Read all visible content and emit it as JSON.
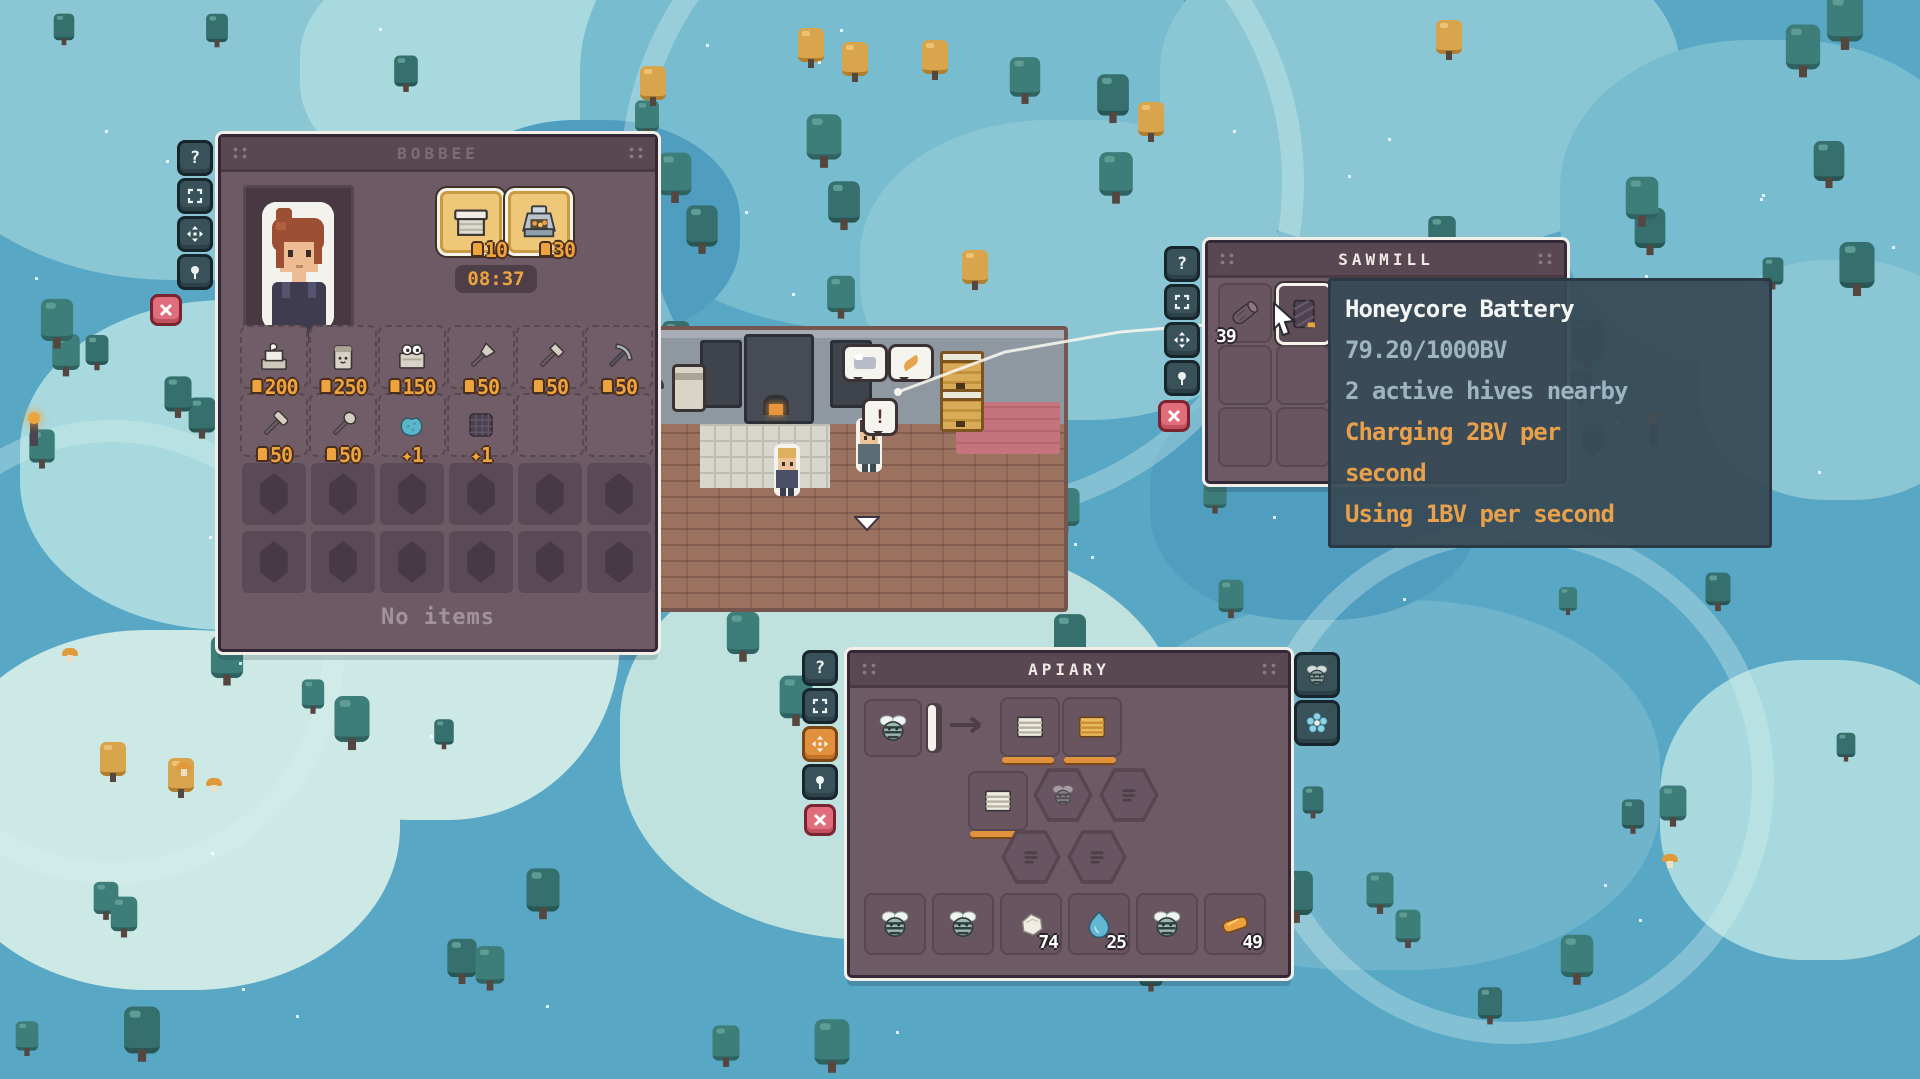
{
  "hud": {
    "help_label": "?"
  },
  "colors": {
    "accent_orange": "#e8a04b",
    "count_orange": "#eda43f",
    "panel_bg": "#6e5a64",
    "tooltip_bg": "#384a56",
    "water": "#57a7c5",
    "gold_slot": "#eec878",
    "close_button": "#e06c7c"
  },
  "player_panel": {
    "title": "BOBBEE",
    "timer": "08:37",
    "equipment": [
      {
        "icon": "workbench-icon",
        "count": "10"
      },
      {
        "icon": "smoker-icon",
        "count": "30"
      }
    ],
    "inventory": [
      {
        "icon": "jar-icon",
        "count": "200"
      },
      {
        "icon": "canister-icon",
        "count": "250"
      },
      {
        "icon": "bee-box-icon",
        "count": "150"
      },
      {
        "icon": "trowel-icon",
        "count": "50"
      },
      {
        "icon": "axe-icon",
        "count": "50"
      },
      {
        "icon": "pickaxe-icon",
        "count": "50"
      },
      {
        "icon": "hammer-icon",
        "count": "50"
      },
      {
        "icon": "scoop-icon",
        "count": "50"
      },
      {
        "icon": "sponge-icon",
        "count": "1"
      },
      {
        "icon": "net-icon",
        "count": "1"
      }
    ],
    "no_items_label": "No items"
  },
  "sawmill_panel": {
    "title": "SAWMILL",
    "input_slot": {
      "icon": "log-icon",
      "count": "39"
    },
    "hovered_slot": {
      "icon": "honeycore-battery-icon"
    }
  },
  "tooltip": {
    "lines": [
      {
        "text": "Honeycore Battery",
        "style": "title"
      },
      {
        "text": "79.20/1000BV",
        "style": "info"
      },
      {
        "text": "2 active hives nearby",
        "style": "info"
      },
      {
        "text": "Charging 2BV per",
        "style": "accent"
      },
      {
        "text": "second",
        "style": "accent"
      },
      {
        "text": "Using 1BV per second",
        "style": "accent"
      }
    ]
  },
  "apiary_panel": {
    "title": "APIARY",
    "input_bee_slot": {
      "icon": "bee-icon"
    },
    "frame_slots": [
      {
        "icon": "frame-empty-icon"
      },
      {
        "icon": "frame-full-icon"
      },
      {
        "icon": "frame-empty-icon"
      }
    ],
    "products": [
      {
        "icon": "bee-icon",
        "count": ""
      },
      {
        "icon": "bee-icon",
        "count": ""
      },
      {
        "icon": "wax-icon",
        "count": "74"
      },
      {
        "icon": "droplet-icon",
        "count": "25"
      },
      {
        "icon": "bee-icon",
        "count": ""
      },
      {
        "icon": "gold-icon",
        "count": "49"
      }
    ]
  },
  "building": {
    "alert_text": "!"
  }
}
